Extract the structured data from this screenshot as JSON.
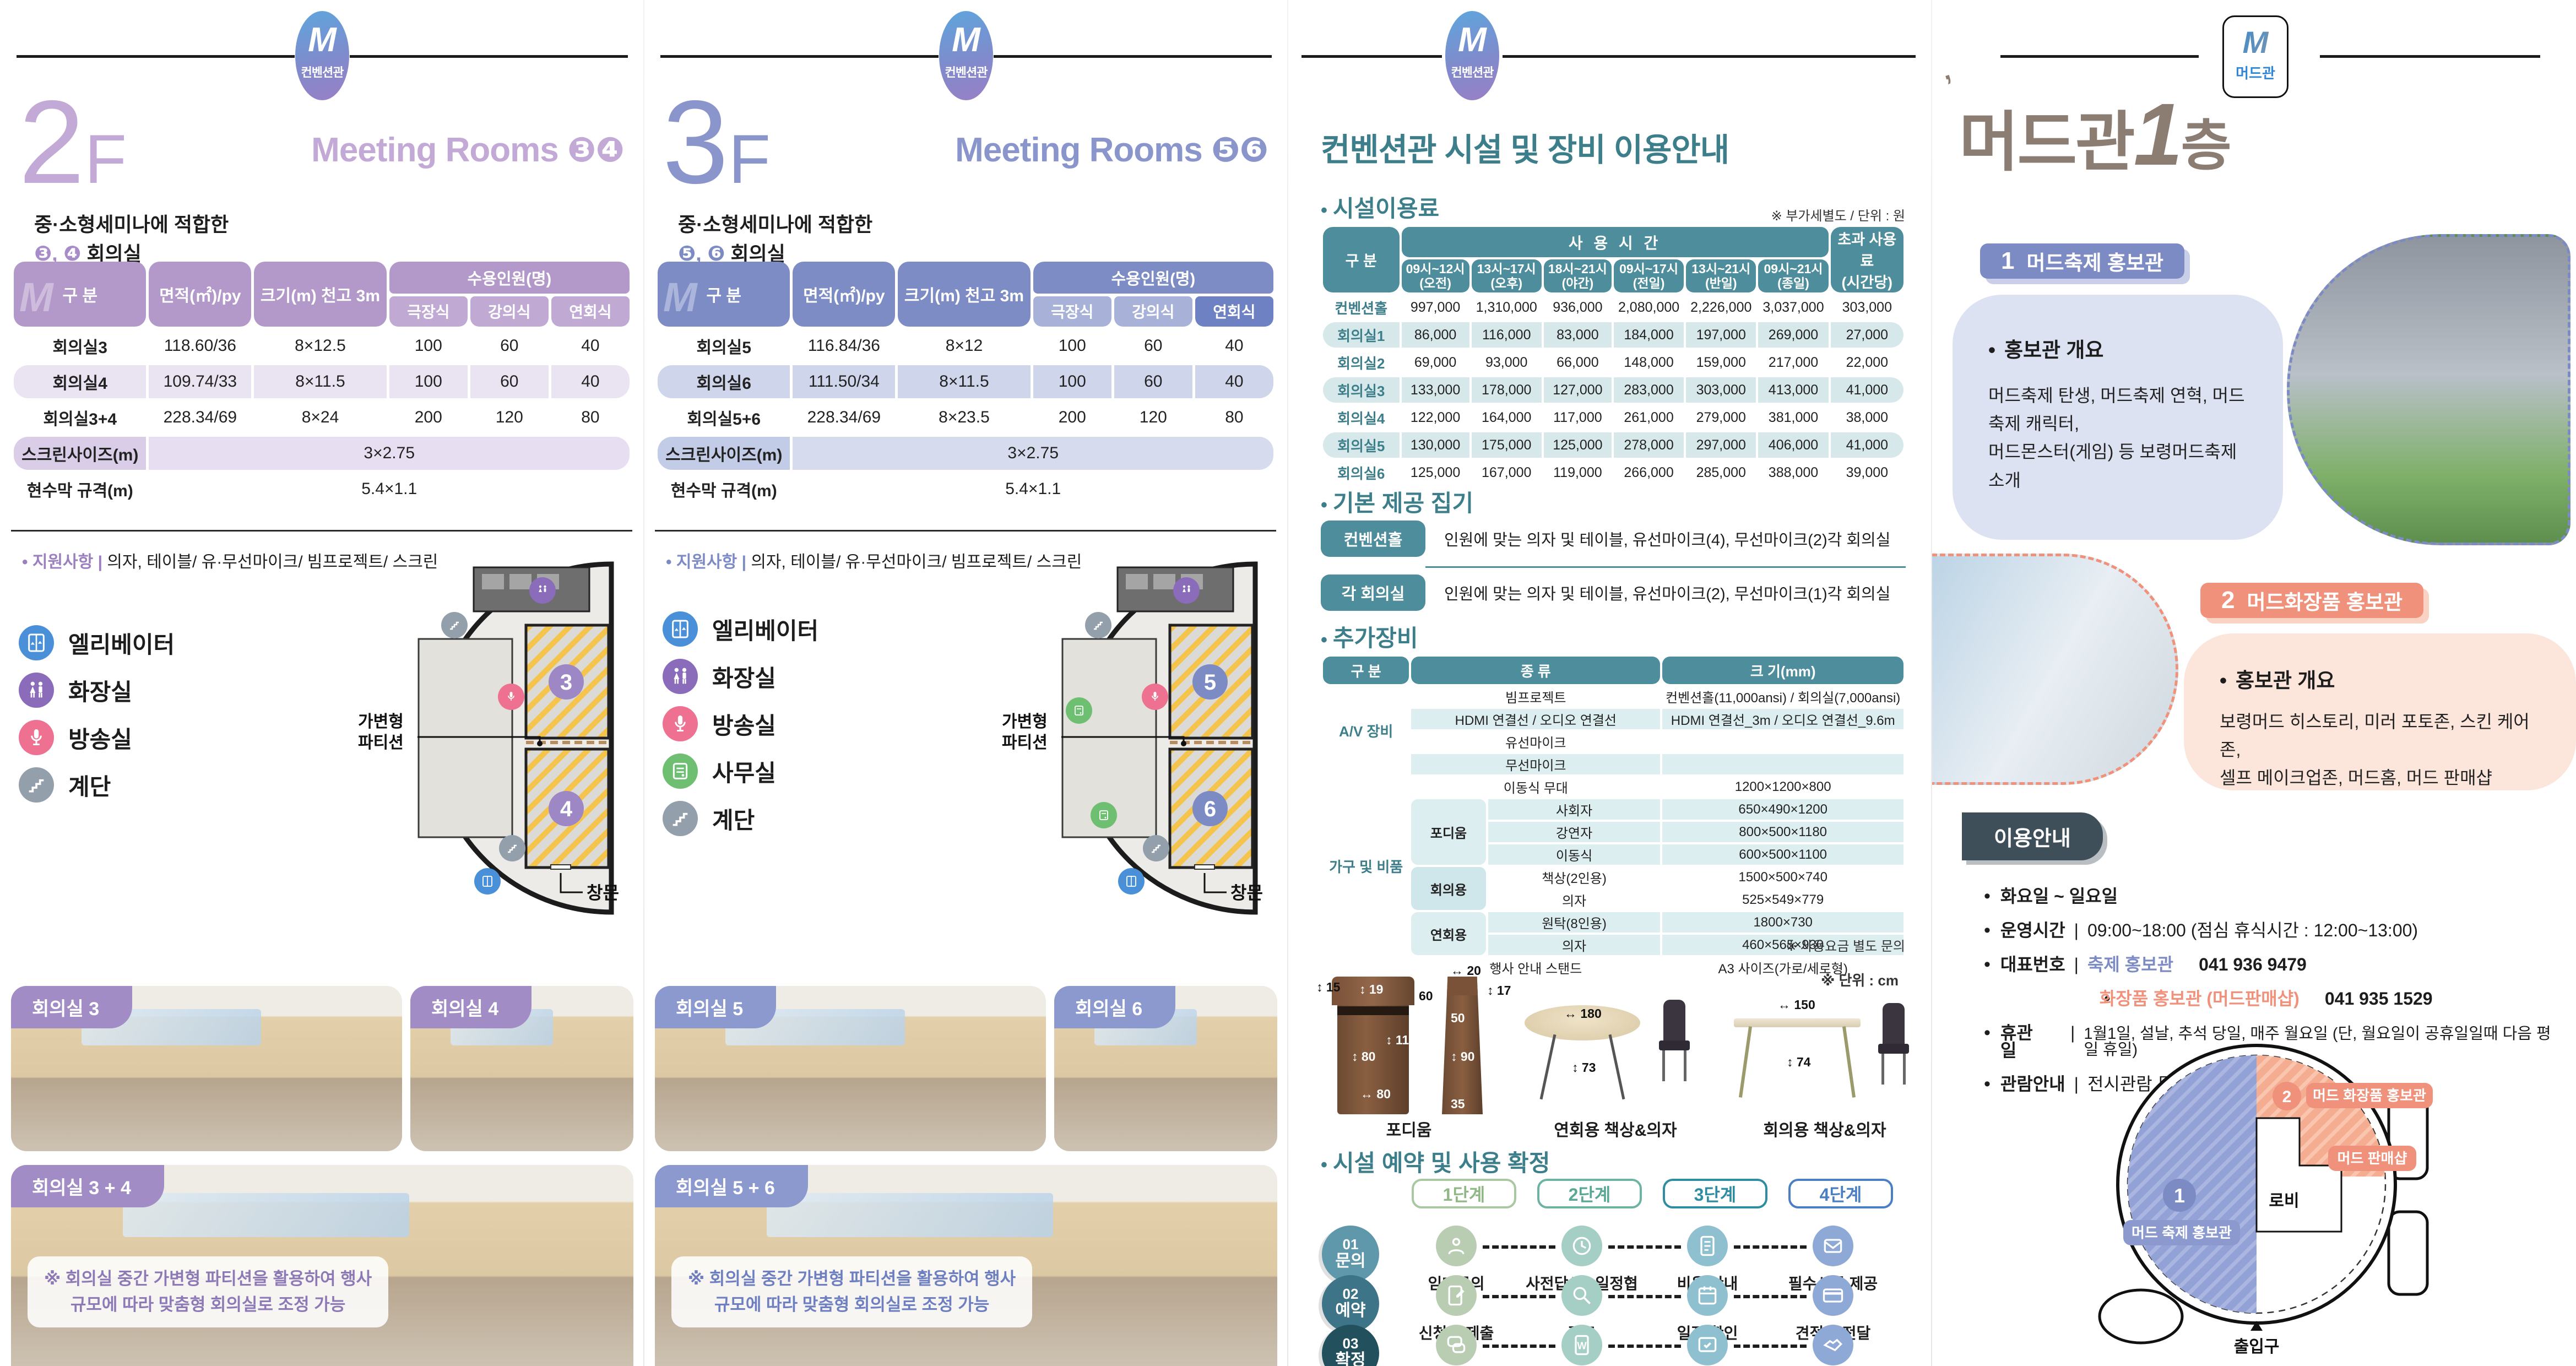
{
  "brand": {
    "logo_m": "M",
    "conv_name": "컨벤션관",
    "mud_name": "머드관"
  },
  "panel1": {
    "floor_num": "2",
    "floor_f": "F",
    "title": "Meeting Rooms",
    "title_nums": "❸❹",
    "intro_line1": "중·소형세미나에 적합한",
    "intro_nums": "❸, ❹",
    "intro_line2": "회의실",
    "table": {
      "col_gubun": "구 분",
      "col_area": "면적(㎡)/py",
      "col_size": "크기(m) 천고 3m",
      "capacity_header": "수용인원(명)",
      "capacity_cols": [
        "극장식",
        "강의식",
        "연회식"
      ],
      "rows": [
        {
          "label": "회의실3",
          "cells": [
            "118.60/36",
            "8×12.5",
            "100",
            "60",
            "40"
          ],
          "alt": false
        },
        {
          "label": "회의실4",
          "cells": [
            "109.74/33",
            "8×11.5",
            "100",
            "60",
            "40"
          ],
          "alt": true
        },
        {
          "label": "회의실3+4",
          "cells": [
            "228.34/69",
            "8×24",
            "200",
            "120",
            "80"
          ],
          "alt": false
        }
      ],
      "span_rows": [
        {
          "label": "스크린사이즈(m)",
          "value": "3×2.75"
        },
        {
          "label": "현수막 규격(m)",
          "value": "5.4×1.1"
        }
      ]
    },
    "support_label": "지원사항",
    "support_text": "의자, 테이블/ 유·무선마이크/ 빔프로젝트/ 스크린",
    "legend": [
      {
        "icon": "elevator",
        "label": "엘리베이터",
        "color": "#4a90d9"
      },
      {
        "icon": "restroom",
        "label": "화장실",
        "color": "#8a6cba"
      },
      {
        "icon": "broadcast",
        "label": "방송실",
        "color": "#ee7191"
      },
      {
        "icon": "stairs",
        "label": "계단",
        "color": "#93a0ab"
      }
    ],
    "floorplan": {
      "partition": "가변형\n파티션",
      "window": "창문",
      "room_a": "3",
      "room_b": "4",
      "office": false,
      "accent": "#9d87c4"
    },
    "photos": {
      "a": "회의실 3",
      "b": "회의실 4",
      "combined": "회의실 3 + 4",
      "caption": "※ 회의실 중간 가변형 파티션을 활용하여 행사\n규모에 따라 맞춤형 회의실로 조정 가능"
    }
  },
  "panel2": {
    "floor_num": "3",
    "floor_f": "F",
    "title": "Meeting Rooms",
    "title_nums": "❺❻",
    "intro_line1": "중·소형세미나에 적합한",
    "intro_nums": "❺, ❻",
    "intro_line2": "회의실",
    "table": {
      "col_gubun": "구 분",
      "col_area": "면적(㎡)/py",
      "col_size": "크기(m) 천고 3m",
      "capacity_header": "수용인원(명)",
      "capacity_cols": [
        "극장식",
        "강의식",
        "연회식"
      ],
      "rows": [
        {
          "label": "회의실5",
          "cells": [
            "116.84/36",
            "8×12",
            "100",
            "60",
            "40"
          ],
          "alt": false
        },
        {
          "label": "회의실6",
          "cells": [
            "111.50/34",
            "8×11.5",
            "100",
            "60",
            "40"
          ],
          "alt": true
        },
        {
          "label": "회의실5+6",
          "cells": [
            "228.34/69",
            "8×23.5",
            "200",
            "120",
            "80"
          ],
          "alt": false
        }
      ],
      "span_rows": [
        {
          "label": "스크린사이즈(m)",
          "value": "3×2.75"
        },
        {
          "label": "현수막 규격(m)",
          "value": "5.4×1.1"
        }
      ]
    },
    "support_label": "지원사항",
    "support_text": "의자, 테이블/ 유·무선마이크/ 빔프로젝트/ 스크린",
    "legend": [
      {
        "icon": "elevator",
        "label": "엘리베이터",
        "color": "#4a90d9"
      },
      {
        "icon": "restroom",
        "label": "화장실",
        "color": "#8a6cba"
      },
      {
        "icon": "broadcast",
        "label": "방송실",
        "color": "#ee7191"
      },
      {
        "icon": "office",
        "label": "사무실",
        "color": "#6fbf73"
      },
      {
        "icon": "stairs",
        "label": "계단",
        "color": "#93a0ab"
      }
    ],
    "floorplan": {
      "partition": "가변형\n파티션",
      "window": "창문",
      "room_a": "5",
      "room_b": "6",
      "office": true,
      "accent": "#7d8bc5"
    },
    "photos": {
      "a": "회의실 5",
      "b": "회의실 6",
      "combined": "회의실 5 + 6",
      "caption": "※ 회의실 중간 가변형 파티션을 활용하여 행사\n규모에 따라 맞춤형 회의실로 조정 가능"
    }
  },
  "panel3": {
    "title": "컨벤션관 시설 및 장비 이용안내",
    "fees": {
      "heading": "시설이용료",
      "note": "※ 부가세별도 / 단위 : 원",
      "col_label": "구 분",
      "time_header": "사 용 시 간",
      "time_cols": [
        [
          "09시~12시",
          "(오전)"
        ],
        [
          "13시~17시",
          "(오후)"
        ],
        [
          "18시~21시",
          "(야간)"
        ],
        [
          "09시~17시",
          "(전일)"
        ],
        [
          "13시~21시",
          "(반일)"
        ],
        [
          "09시~21시",
          "(종일)"
        ]
      ],
      "extra_col": [
        "초과 사용료",
        "(시간당)"
      ],
      "rows": [
        {
          "label": "컨벤션홀",
          "cells": [
            "997,000",
            "1,310,000",
            "936,000",
            "2,080,000",
            "2,226,000",
            "3,037,000",
            "303,000"
          ],
          "alt": false
        },
        {
          "label": "회의실1",
          "cells": [
            "86,000",
            "116,000",
            "83,000",
            "184,000",
            "197,000",
            "269,000",
            "27,000"
          ],
          "alt": true
        },
        {
          "label": "회의실2",
          "cells": [
            "69,000",
            "93,000",
            "66,000",
            "148,000",
            "159,000",
            "217,000",
            "22,000"
          ],
          "alt": false
        },
        {
          "label": "회의실3",
          "cells": [
            "133,000",
            "178,000",
            "127,000",
            "283,000",
            "303,000",
            "413,000",
            "41,000"
          ],
          "alt": true
        },
        {
          "label": "회의실4",
          "cells": [
            "122,000",
            "164,000",
            "117,000",
            "261,000",
            "279,000",
            "381,000",
            "38,000"
          ],
          "alt": false
        },
        {
          "label": "회의실5",
          "cells": [
            "130,000",
            "175,000",
            "125,000",
            "278,000",
            "297,000",
            "406,000",
            "41,000"
          ],
          "alt": true
        },
        {
          "label": "회의실6",
          "cells": [
            "125,000",
            "167,000",
            "119,000",
            "266,000",
            "285,000",
            "388,000",
            "39,000"
          ],
          "alt": false
        }
      ]
    },
    "included": {
      "heading": "기본 제공 집기",
      "rows": [
        {
          "badge": "컨벤션홀",
          "text": "인원에 맞는 의자 및 테이블, 유선마이크(4), 무선마이크(2)각 회의실"
        },
        {
          "badge": "각 회의실",
          "text": "인원에 맞는 의자 및 테이블, 유선마이크(2), 무선마이크(1)각 회의실"
        }
      ]
    },
    "equipment": {
      "heading": "추가장비",
      "headers": [
        "구 분",
        "종 류",
        "크 기(mm)"
      ],
      "groups": [
        {
          "name": "A/V 장비",
          "rows": [
            {
              "item": "빔프로젝트",
              "size": "컨벤션홀(11,000ansi) / 회의실(7,000ansi)",
              "alt": false
            },
            {
              "item": "HDMI 연결선 / 오디오 연결선",
              "size": "HDMI 연결선_3m / 오디오 연결선_9.6m",
              "alt": true
            },
            {
              "item": "유선마이크",
              "size": "",
              "alt": false
            },
            {
              "item": "무선마이크",
              "size": "",
              "alt": true
            }
          ]
        },
        {
          "name": "가구 및 비품",
          "rows": [
            {
              "item": "이동식 무대",
              "size": "1200×1200×800",
              "alt": false
            },
            {
              "sub": "포디움",
              "subspan": 3,
              "item": "사회자",
              "size": "650×490×1200",
              "alt": true
            },
            {
              "item": "강연자",
              "size": "800×500×1180",
              "alt": true
            },
            {
              "item": "이동식",
              "size": "600×500×1100",
              "alt": true
            },
            {
              "sub": "회의용",
              "subspan": 2,
              "item": "책상(2인용)",
              "size": "1500×500×740",
              "alt": false
            },
            {
              "item": "의자",
              "size": "525×549×779",
              "alt": false
            },
            {
              "sub": "연회용",
              "subspan": 2,
              "item": "원탁(8인용)",
              "size": "1800×730",
              "alt": true
            },
            {
              "item": "의자",
              "size": "460×565×930",
              "alt": true
            }
          ]
        }
      ],
      "footer": {
        "item": "행사 안내 스탠드",
        "size": "A3 사이즈(가로/세로형)"
      },
      "note": "※ 사용요금 별도 문의"
    },
    "furniture": {
      "unit_note": "※ 단위 : cm",
      "cap_podium": "포디움",
      "cap_round": "연회용 책상&의자",
      "cap_desk": "회의용 책상&의자",
      "pod_front": {
        "d1": "15",
        "d2": "19",
        "d3": "80",
        "d4": "110",
        "d5": "80"
      },
      "pod_side": {
        "d1": "20",
        "d2": "60",
        "d3": "17",
        "d4": "50",
        "d5": "90",
        "d6": "35"
      },
      "round": {
        "dia": "180",
        "h": "73"
      },
      "desk": {
        "w": "150",
        "h": "74"
      }
    },
    "process": {
      "heading": "시설 예약 및 사용 확정",
      "steps": [
        "1단계",
        "2단계",
        "3단계",
        "4단계"
      ],
      "rows": [
        {
          "num": "01",
          "name": "문의",
          "items": [
            {
              "icon": "person",
              "label": "임대문의"
            },
            {
              "icon": "clock",
              "label": "사전답사 / 일정협의"
            },
            {
              "icon": "doc",
              "label": "비용 안내"
            },
            {
              "icon": "mail",
              "label": "필수서류 제공"
            }
          ]
        },
        {
          "num": "02",
          "name": "예약",
          "items": [
            {
              "icon": "form",
              "label": "신청서 제출"
            },
            {
              "icon": "search",
              "label": "검토"
            },
            {
              "icon": "calendar",
              "label": "일정 확인"
            },
            {
              "icon": "card",
              "label": "견적서 전달"
            }
          ]
        },
        {
          "num": "03",
          "name": "확정",
          "items": [
            {
              "icon": "chat",
              "label": "세부사항 확정"
            },
            {
              "icon": "contract",
              "label": "대관계약"
            },
            {
              "icon": "settle",
              "label": "정산",
              "sub": "(계약금/잔금 납부)"
            },
            {
              "icon": "handshake",
              "label": "행사 추진"
            }
          ]
        }
      ]
    }
  },
  "panel4": {
    "title_main": "머드관",
    "title_num": "1",
    "title_floor": "층",
    "drop": "’",
    "sec1": {
      "badge_num": "1",
      "badge": "머드축제 홍보관",
      "overview": "홍보관 개요",
      "body": "머드축제 탄생, 머드축제 연혁, 머드축제 캐릭터,\n머드몬스터(게임) 등  보령머드축제 소개"
    },
    "sec2": {
      "badge_num": "2",
      "badge": "머드화장품 홍보관",
      "overview": "홍보관 개요",
      "body": "보령머드 히스토리, 미러 포토존, 스킨 케어존,\n셀프 메이크업존, 머드홈, 머드 판매샵"
    },
    "usage": {
      "title": "이용안내",
      "days": "화요일 ~ 일요일",
      "hours_label": "운영시간",
      "hours": "09:00~18:00 (점심 휴식시간 : 12:00~13:00)",
      "phone_label": "대표번호",
      "phone1_name": "축제 홍보관",
      "phone1": "041 936 9479",
      "phone2_name": "화장품 홍보관 (머드판매샵)",
      "phone2": "041 935 1529",
      "closed_label": "휴관일",
      "closed": "1월1일, 설날, 추석 당일, 매주 월요일 (단, 월요일이 공휴일일때 다음 평일 휴일)",
      "view_label": "관람안내",
      "view": "전시관람 무료"
    },
    "map": {
      "a_num": "1",
      "a_label": "머드 축제 홍보관",
      "b_num": "2",
      "b_label": "머드 화장품 홍보관",
      "shop": "머드 판매샵",
      "lobby": "로비",
      "entrance": "출입구"
    }
  }
}
